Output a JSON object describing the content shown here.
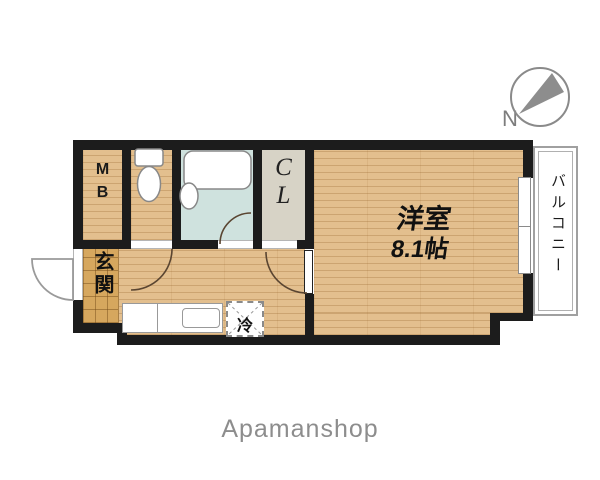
{
  "colors": {
    "wall": "#1c1c1c",
    "wood_floor": "#e3bf8e",
    "entrance_tile": "#d6a75e",
    "bath_floor": "#cfe2de",
    "closet_floor": "#d7d3c6",
    "balcony_line": "#a0a0a0",
    "door_arc": "#5a4531",
    "brand_text": "#8d8d8d"
  },
  "compass": {
    "north_label": "N"
  },
  "rooms": {
    "meter_box": {
      "line1": "M",
      "line2": "B"
    },
    "closet": {
      "line1": "C",
      "line2": "L"
    },
    "main": {
      "name": "洋室",
      "size": "8.1帖"
    },
    "entrance": {
      "label": "玄関"
    },
    "balcony": {
      "label": "バルコニー"
    },
    "kitchen": {
      "fridge": "冷"
    }
  },
  "footer": {
    "brand": "Apamanshop"
  }
}
